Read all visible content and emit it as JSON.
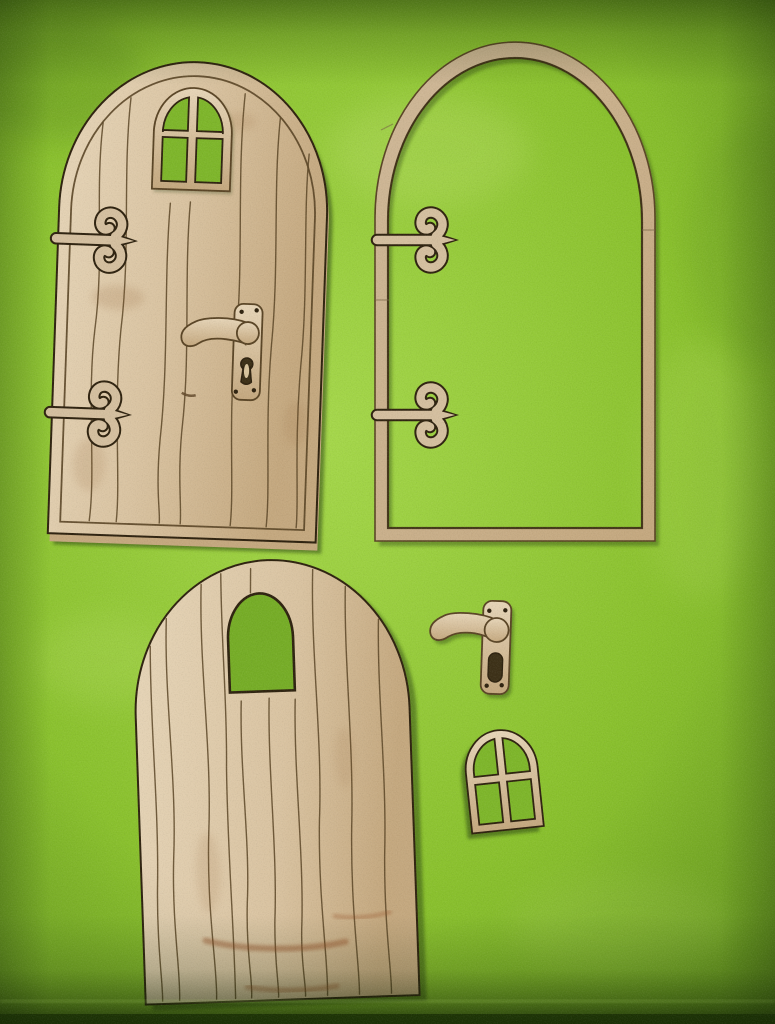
{
  "meta": {
    "description": "Photograph of a laser-cut plywood fairy-door craft kit: five wooden pieces arranged on bright green felt",
    "alt": "Five plywood fairy door craft pieces laid out on a bright green felt background"
  },
  "colors": {
    "felt-base": "#8ac12e",
    "felt-light": "#a5d74b",
    "felt-dark": "#6fa323",
    "wood-light": "#e6d5b8",
    "wood-mid": "#d9c3a1",
    "wood-dark": "#c4a87f",
    "wood-frame": "#cfb898",
    "wood-hinge": "#d4bf9f",
    "burn-line": "#5a4526",
    "burn-edge": "#2f2310",
    "shadow-green": "#22370a",
    "pane-green": "#7eb62b",
    "hole-green": "#76ad27",
    "keyhole-dark": "#3d3118",
    "keyhole-light": "#d8c49c",
    "knot-brown": "#8a5a2e",
    "streak-red": "#924c24"
  },
  "pieces": [
    {
      "id": "assembled-door",
      "label": "Assembled arched fairy door with four-pane window, two scroll hinges and lever handle",
      "position": "top-left"
    },
    {
      "id": "door-frame",
      "label": "Arched plywood door frame outline with two scroll hinges",
      "position": "top-right"
    },
    {
      "id": "door-blank",
      "label": "Plain arched door blank with arched window cut-out and wood-grain engraving",
      "position": "bottom-left"
    },
    {
      "id": "door-handle",
      "label": "Separate lever door handle on backplate with keyhole",
      "position": "middle-right"
    },
    {
      "id": "window",
      "label": "Separate small arched four-pane window frame",
      "position": "bottom-right"
    }
  ]
}
